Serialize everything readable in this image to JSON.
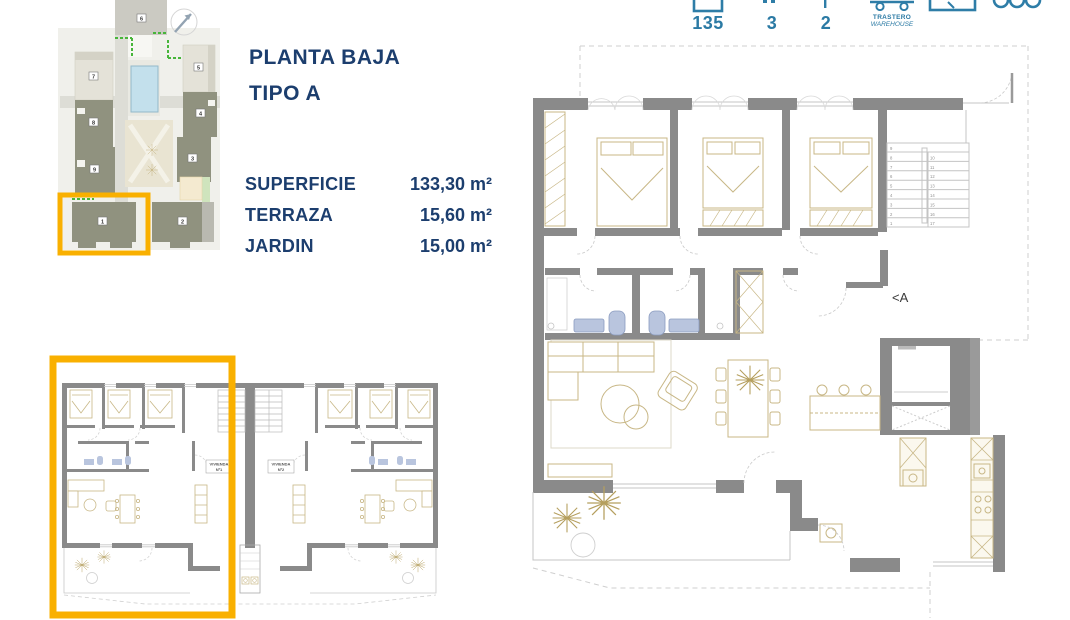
{
  "header": {
    "area_value": "135",
    "bedrooms_value": "3",
    "bathrooms_value": "2",
    "storage_label": "TRASTERO",
    "storage_label_en": "WAREHOUSE"
  },
  "title": {
    "line1": "PLANTA BAJA",
    "line2": "TIPO A"
  },
  "specs": [
    {
      "label": "SUPERFICIE",
      "value": "133,30 m²"
    },
    {
      "label": "TERRAZA",
      "value": "15,60 m²"
    },
    {
      "label": "JARDIN",
      "value": "15,00 m²"
    }
  ],
  "site_plan": {
    "buildings": [
      "1",
      "2",
      "3",
      "4",
      "5",
      "6",
      "7",
      "8",
      "9"
    ]
  },
  "main_plan": {
    "section_label": "<A",
    "stair_numbers_left": [
      "9",
      "8",
      "7",
      "6",
      "5",
      "4",
      "3",
      "2",
      "1"
    ],
    "stair_numbers_right": [
      "10",
      "11",
      "12",
      "13",
      "14",
      "15",
      "16",
      "17"
    ]
  },
  "units_plan": {
    "unit1": {
      "line1": "VIVIENDA",
      "line2": "Nº1"
    },
    "unit2": {
      "line1": "VIVIENDA",
      "line2": "Nº2"
    }
  },
  "colors": {
    "accent_orange": "#F9B000",
    "navy": "#1C3E6E",
    "teal": "#2E7DA7"
  }
}
